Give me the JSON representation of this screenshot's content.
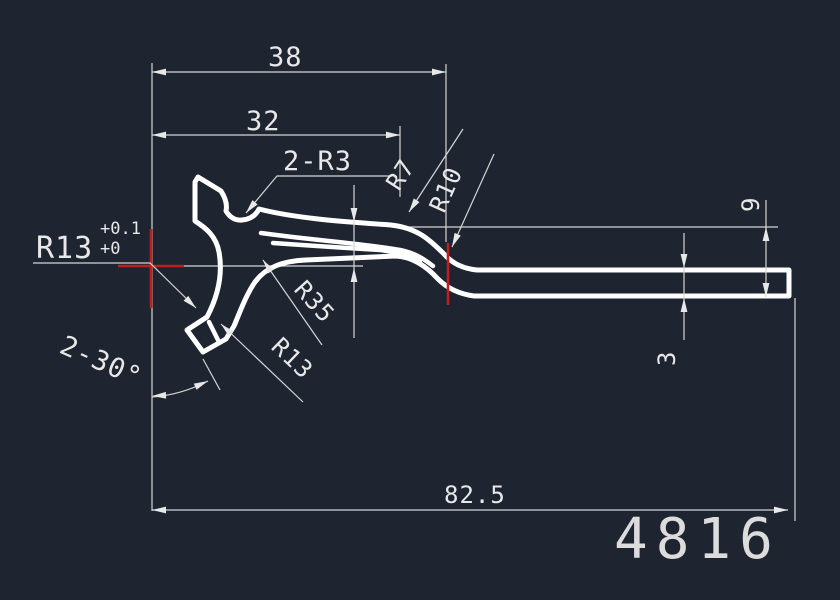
{
  "drawing": {
    "part_number": "4816",
    "dimensions": {
      "width_top": "38",
      "width_mid": "32",
      "length_total": "82.5",
      "height_right": "9",
      "thickness_right": "3",
      "fillet_note": "2-R3",
      "radius_r7": "R7",
      "radius_r10": "R10",
      "radius_r13_label": "R13",
      "r13_tol_upper": "+0.1",
      "r13_tol_lower": "+0",
      "radius_r35": "R35",
      "radius_r13_lower": "R13",
      "chamfer_note": "2-30°"
    },
    "colors": {
      "background": "#1e2430",
      "lines": "#e8e8e8",
      "part_outline": "#ffffff",
      "center_mark_red": "#c01f1f"
    }
  }
}
